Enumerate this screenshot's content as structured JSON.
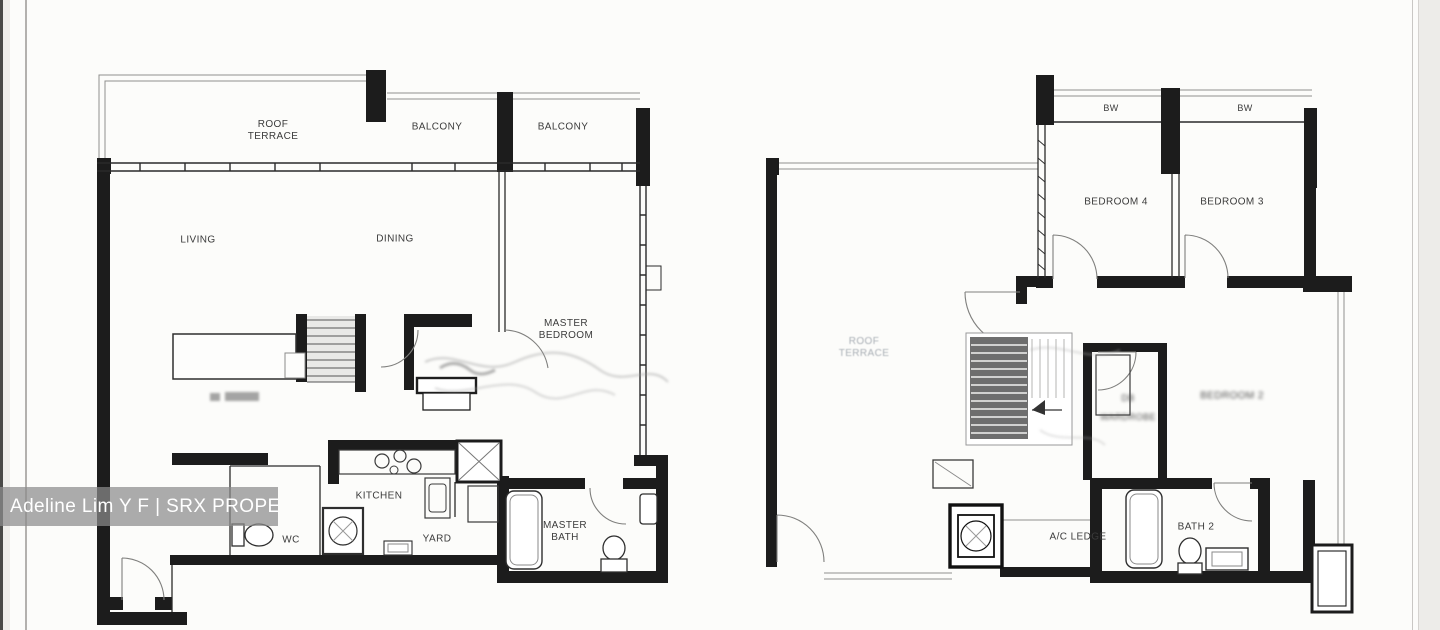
{
  "watermark": {
    "text": "Adeline Lim Y F | SRX PROPERTY",
    "band_color": "#8c8c8c",
    "text_color": "#ffffff"
  },
  "floor_plan_left": {
    "name": "lower-floor-plan",
    "labels": {
      "roof_terrace": "ROOF TERRACE",
      "balcony_1": "BALCONY",
      "balcony_2": "BALCONY",
      "living": "LIVING",
      "dining": "DINING",
      "master_bedroom": "MASTER BEDROOM",
      "kitchen": "KITCHEN",
      "wc": "WC",
      "yard": "YARD",
      "master_bath": "MASTER BATH"
    }
  },
  "floor_plan_right": {
    "name": "upper-floor-plan",
    "labels": {
      "bw_1": "BW",
      "bw_2": "BW",
      "bedroom_4": "BEDROOM 4",
      "bedroom_3": "BEDROOM 3",
      "roof_terrace_faded": "ROOF TERRACE",
      "db_blurred": "DB",
      "wardrobe_blurred": "WARDROBE",
      "bedroom_2_blurred": "BEDROOM 2",
      "ac_ledge": "A/C LEDGE",
      "bath_2": "BATH 2"
    }
  }
}
